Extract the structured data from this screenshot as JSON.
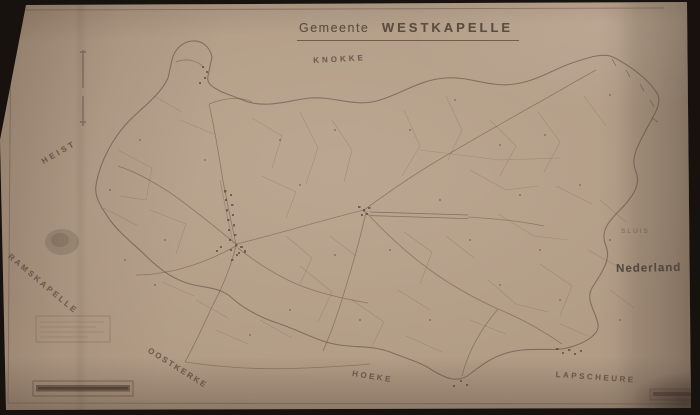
{
  "title": {
    "prefix": "Gemeente",
    "name": "WESTKAPELLE"
  },
  "labels": {
    "knokke": "KNOKKE",
    "heist": "HEIST",
    "ramskapelle": "RAMSKAPELLE",
    "oostkerke": "OOSTKERKE",
    "hoeke": "HOEKE",
    "lapscheure": "LAPSCHEURE",
    "sluis": "SLUIS",
    "nederland": "Nederland"
  },
  "colors": {
    "paper": "#b29c86",
    "ink": "#5f4c40",
    "photo_background": "#17120e"
  }
}
